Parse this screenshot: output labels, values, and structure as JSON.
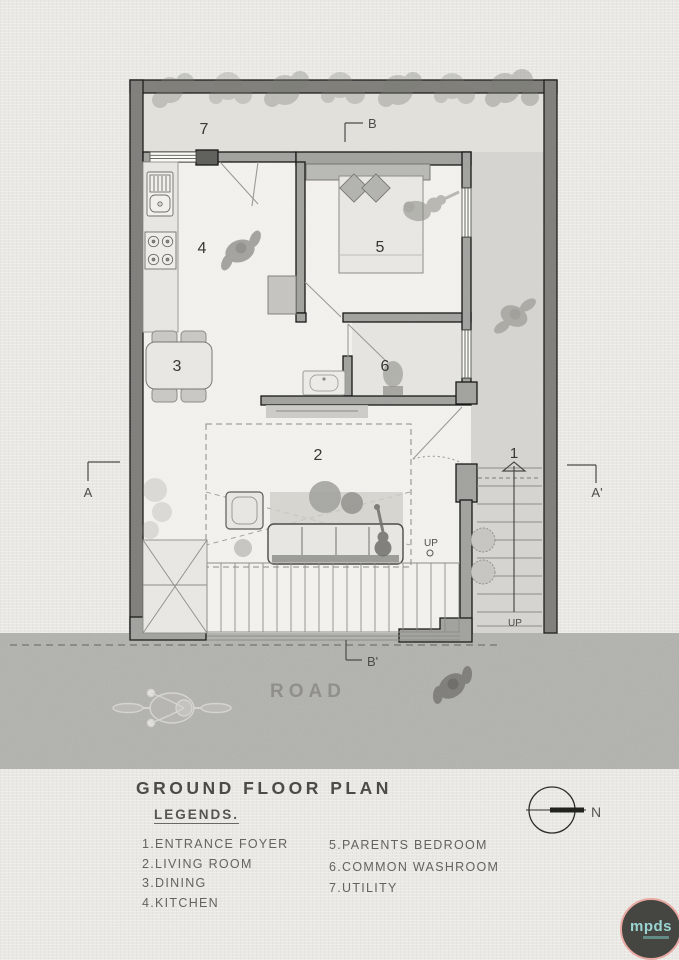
{
  "plan_labels": {
    "room1": "1",
    "room2": "2",
    "room3": "3",
    "room4": "4",
    "room5": "5",
    "room6": "6",
    "room7": "7",
    "section_a": "A",
    "section_a_prime": "A'",
    "section_b": "B",
    "section_b_prime": "B'",
    "up_living": "UP",
    "up_entry": "UP",
    "road": "ROAD",
    "north": "N"
  },
  "title_block": {
    "title": "GROUND FLOOR PLAN",
    "legend_heading": "LEGENDS.",
    "legend_col1": [
      "1.ENTRANCE FOYER",
      "2.LIVING ROOM",
      "3.DINING",
      "4.KITCHEN"
    ],
    "legend_col2": [
      "5.PARENTS BEDROOM",
      "6.COMMON WASHROOM",
      "7.UTILITY"
    ]
  },
  "logo": {
    "text": "mpds"
  },
  "colors": {
    "paper": "#eae9e5",
    "road": "#b2b2ae",
    "boundary_wall": "#807f7b",
    "house_wall": "#a2a29e",
    "logo_bg": "#454542",
    "logo_ring": "#e9a9a3",
    "logo_text": "#9bd5d1"
  }
}
